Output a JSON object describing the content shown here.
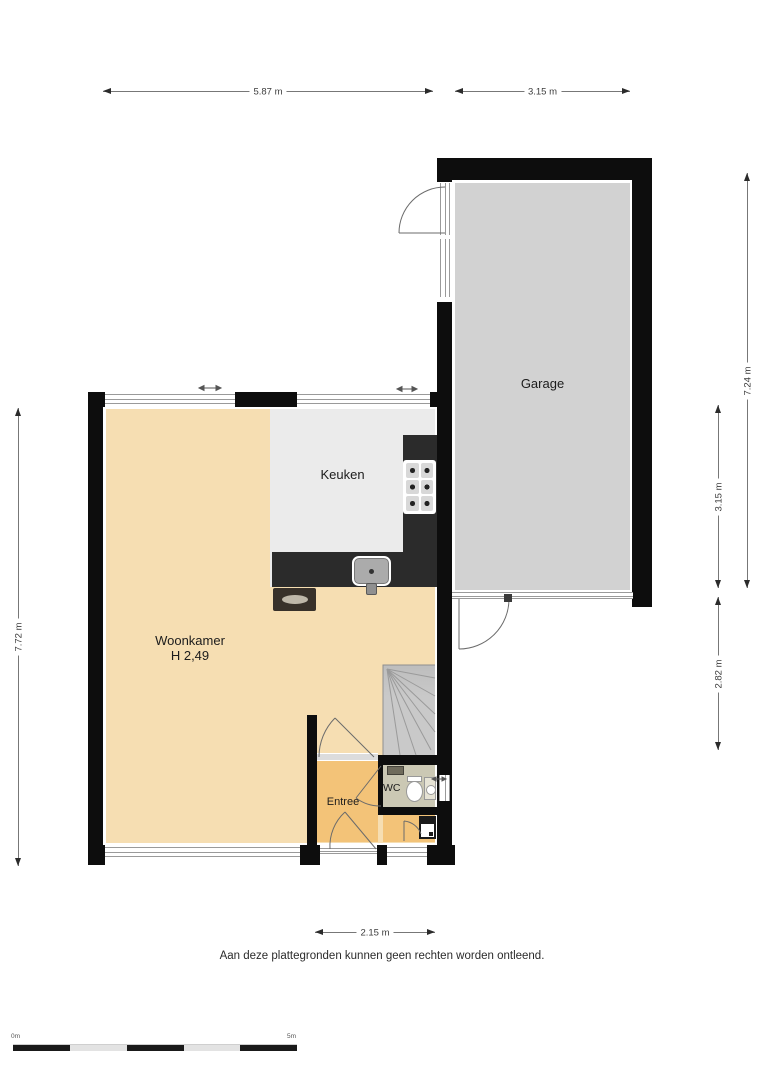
{
  "labels": {
    "garage": "Garage",
    "keuken": "Keuken",
    "woonkamer": "Woonkamer",
    "woonkamer_height": "H 2,49",
    "entree": "Entree",
    "wc": "WC"
  },
  "dimensions": {
    "top_main": "5.87 m",
    "top_garage": "3.15 m",
    "left_main": "7.72 m",
    "right_garage": "7.24 m",
    "right_upper": "3.15 m",
    "right_lower": "2.82 m",
    "bottom_entree": "2.15 m"
  },
  "scale_bar": {
    "start_label": "0m",
    "end_label": "5m"
  },
  "footer": {
    "disclaimer": "Aan deze plattegronden kunnen geen rechten worden ontleend."
  },
  "colors": {
    "wall": "#0d0d0d",
    "garage_floor": "#d2d2d2",
    "keuken_floor": "#ebebeb",
    "woonkamer_floor": "#f6deb2",
    "entree_floor": "#f3c378",
    "wc_floor": "#cbc8b4",
    "stairs": "#c9c9c9",
    "counter": "#2b2b2b",
    "dim_line": "#777777"
  }
}
